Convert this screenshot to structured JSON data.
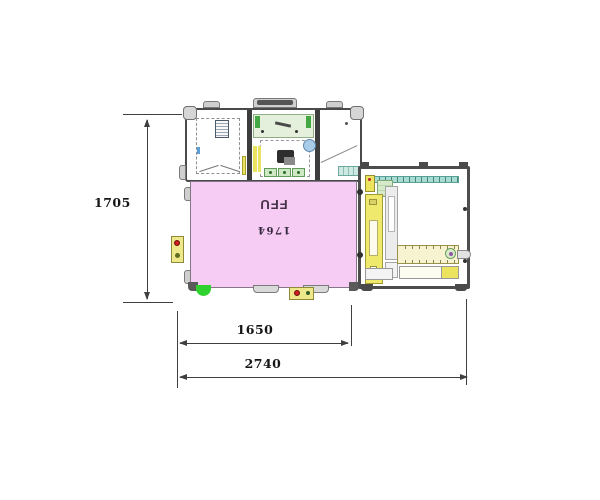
{
  "diagram": {
    "type": "equipment-layout-plan",
    "ffu": {
      "label": "FFU",
      "sublabel": "1764"
    },
    "dimensions": {
      "height": "1705",
      "width_inner": "1650",
      "width_total": "2740"
    },
    "colors": {
      "background": "#FFFFFF",
      "ffu_fill": "#F6CBF4",
      "frame": "#4A4A4A",
      "teal_rail": "#A8DCD2",
      "yellow_component": "#EFE96D",
      "panel_green": "#E4F0DC",
      "indicator_green": "#2FD12F",
      "indicator_red": "#CF1F1F",
      "port_blue": "#A9CDE8",
      "dim_line": "#3F3F3F"
    }
  }
}
